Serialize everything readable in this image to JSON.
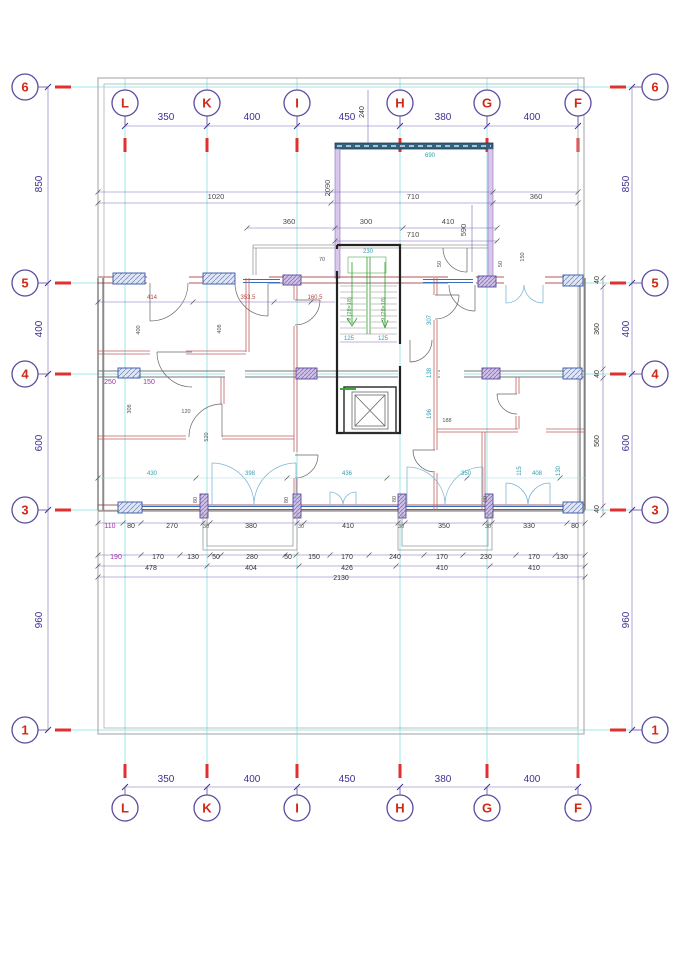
{
  "drawing": {
    "type": "architectural-floor-plan",
    "grid": {
      "columns": [
        {
          "label": "L",
          "x": 125
        },
        {
          "label": "K",
          "x": 207
        },
        {
          "label": "I",
          "x": 297
        },
        {
          "label": "H",
          "x": 400
        },
        {
          "label": "G",
          "x": 487
        },
        {
          "label": "F",
          "x": 578
        }
      ],
      "rows": [
        {
          "label": "6",
          "y": 87
        },
        {
          "label": "5",
          "y": 283
        },
        {
          "label": "4",
          "y": 374
        },
        {
          "label": "3",
          "y": 510
        },
        {
          "label": "1",
          "y": 730
        }
      ],
      "top_bubble_y": 103,
      "bottom_bubble_y": 808,
      "left_bubble_x": 25,
      "right_bubble_x": 655
    },
    "column_spacings": [
      "350",
      "400",
      "450",
      "380",
      "400"
    ],
    "row_spacings": [
      "850",
      "400",
      "600",
      "960"
    ],
    "stair_flight_label": "9 (28×18)",
    "colors": {
      "grid_line": "#9fe4e4",
      "bubble_stroke": "#5b4a9e",
      "bubble_label": "#d22818",
      "red_tick": "#e03030",
      "dim_major": "#3c3294",
      "wall_fill": "#d9c7ec",
      "window_blue": "#3a6fc0",
      "stair_green": "#2f9e2f",
      "partition_red": "#c06060"
    },
    "dimensions": [
      {
        "text": "350",
        "x": 166,
        "y": 120,
        "cls": "maj"
      },
      {
        "text": "400",
        "x": 252,
        "y": 120,
        "cls": "maj"
      },
      {
        "text": "450",
        "x": 347,
        "y": 120,
        "cls": "maj"
      },
      {
        "text": "240",
        "x": 364,
        "y": 112,
        "cls": "chain",
        "rot": 1
      },
      {
        "text": "380",
        "x": 443,
        "y": 120,
        "cls": "maj"
      },
      {
        "text": "400",
        "x": 532,
        "y": 120,
        "cls": "maj"
      },
      {
        "text": "350",
        "x": 166,
        "y": 782,
        "cls": "maj"
      },
      {
        "text": "400",
        "x": 252,
        "y": 782,
        "cls": "maj"
      },
      {
        "text": "450",
        "x": 347,
        "y": 782,
        "cls": "maj"
      },
      {
        "text": "380",
        "x": 443,
        "y": 782,
        "cls": "maj"
      },
      {
        "text": "400",
        "x": 532,
        "y": 782,
        "cls": "maj"
      },
      {
        "text": "850",
        "x": 42,
        "y": 184,
        "cls": "maj",
        "rot": 1
      },
      {
        "text": "400",
        "x": 42,
        "y": 329,
        "cls": "maj",
        "rot": 1
      },
      {
        "text": "600",
        "x": 42,
        "y": 443,
        "cls": "maj",
        "rot": 1
      },
      {
        "text": "960",
        "x": 42,
        "y": 620,
        "cls": "maj",
        "rot": 1
      },
      {
        "text": "850",
        "x": 629,
        "y": 184,
        "cls": "maj",
        "rot": 1
      },
      {
        "text": "400",
        "x": 629,
        "y": 329,
        "cls": "maj",
        "rot": 1
      },
      {
        "text": "600",
        "x": 629,
        "y": 443,
        "cls": "maj",
        "rot": 1
      },
      {
        "text": "960",
        "x": 629,
        "y": 620,
        "cls": "maj",
        "rot": 1
      },
      {
        "text": "40",
        "x": 599,
        "y": 280,
        "cls": "chain",
        "rot": 1
      },
      {
        "text": "360",
        "x": 599,
        "y": 329,
        "cls": "chain",
        "rot": 1
      },
      {
        "text": "40",
        "x": 599,
        "y": 374,
        "cls": "chain",
        "rot": 1
      },
      {
        "text": "560",
        "x": 599,
        "y": 441,
        "cls": "chain",
        "rot": 1
      },
      {
        "text": "40",
        "x": 599,
        "y": 509,
        "cls": "chain",
        "rot": 1
      },
      {
        "text": "1020",
        "x": 216,
        "y": 199,
        "cls": "mid"
      },
      {
        "text": "710",
        "x": 413,
        "y": 199,
        "cls": "mid"
      },
      {
        "text": "360",
        "x": 536,
        "y": 199,
        "cls": "mid"
      },
      {
        "text": "690",
        "x": 430,
        "y": 157,
        "cls": "cyan"
      },
      {
        "text": "2090",
        "x": 330,
        "y": 188,
        "cls": "mid",
        "rot": 1
      },
      {
        "text": "360",
        "x": 289,
        "y": 224,
        "cls": "mid"
      },
      {
        "text": "300",
        "x": 366,
        "y": 224,
        "cls": "mid"
      },
      {
        "text": "410",
        "x": 448,
        "y": 224,
        "cls": "mid"
      },
      {
        "text": "710",
        "x": 413,
        "y": 237,
        "cls": "mid"
      },
      {
        "text": "590",
        "x": 466,
        "y": 230,
        "cls": "mid",
        "rot": 1
      },
      {
        "text": "70",
        "x": 322,
        "y": 261,
        "cls": "tiny"
      },
      {
        "text": "50",
        "x": 441,
        "y": 264,
        "cls": "tiny",
        "rot": 1
      },
      {
        "text": "50",
        "x": 502,
        "y": 264,
        "cls": "tiny",
        "rot": 1
      },
      {
        "text": "150",
        "x": 524,
        "y": 257,
        "cls": "tiny",
        "rot": 1
      },
      {
        "text": "414",
        "x": 152,
        "y": 299,
        "cls": "red"
      },
      {
        "text": "353.5",
        "x": 248,
        "y": 299,
        "cls": "red"
      },
      {
        "text": "160.5",
        "x": 315,
        "y": 299,
        "cls": "red"
      },
      {
        "text": "400",
        "x": 140,
        "y": 330,
        "cls": "tiny",
        "rot": 1
      },
      {
        "text": "408",
        "x": 221,
        "y": 329,
        "cls": "tiny",
        "rot": 1
      },
      {
        "text": "250",
        "x": 110,
        "y": 384,
        "cls": "chainp"
      },
      {
        "text": "150",
        "x": 149,
        "y": 384,
        "cls": "chainp"
      },
      {
        "text": "308",
        "x": 131,
        "y": 409,
        "cls": "tiny",
        "rot": 1
      },
      {
        "text": "120",
        "x": 186,
        "y": 413,
        "cls": "tiny"
      },
      {
        "text": "520",
        "x": 208,
        "y": 437,
        "cls": "tiny",
        "rot": 1
      },
      {
        "text": "307",
        "x": 431,
        "y": 320,
        "cls": "cyan",
        "rot": 1
      },
      {
        "text": "138",
        "x": 431,
        "y": 373,
        "cls": "cyan",
        "rot": 1
      },
      {
        "text": "196",
        "x": 431,
        "y": 414,
        "cls": "cyan",
        "rot": 1
      },
      {
        "text": "188",
        "x": 447,
        "y": 422,
        "cls": "tiny"
      },
      {
        "text": "230",
        "x": 368,
        "y": 253,
        "cls": "cyan"
      },
      {
        "text": "125",
        "x": 349,
        "y": 340,
        "cls": "cyan"
      },
      {
        "text": "125",
        "x": 383,
        "y": 340,
        "cls": "cyan"
      },
      {
        "text": "430",
        "x": 152,
        "y": 475,
        "cls": "cyan"
      },
      {
        "text": "398",
        "x": 250,
        "y": 475,
        "cls": "cyan"
      },
      {
        "text": "436",
        "x": 347,
        "y": 475,
        "cls": "cyan"
      },
      {
        "text": "350",
        "x": 466,
        "y": 475,
        "cls": "cyan"
      },
      {
        "text": "408",
        "x": 537,
        "y": 475,
        "cls": "cyan"
      },
      {
        "text": "115",
        "x": 521,
        "y": 471,
        "cls": "cyan",
        "rot": 1
      },
      {
        "text": "130",
        "x": 560,
        "y": 471,
        "cls": "cyan",
        "rot": 1
      },
      {
        "text": "80",
        "x": 197,
        "y": 500,
        "cls": "tiny",
        "rot": 1
      },
      {
        "text": "80",
        "x": 288,
        "y": 500,
        "cls": "tiny",
        "rot": 1
      },
      {
        "text": "80",
        "x": 396,
        "y": 499,
        "cls": "tiny",
        "rot": 1
      },
      {
        "text": "80",
        "x": 487,
        "y": 499,
        "cls": "tiny",
        "rot": 1
      },
      {
        "text": "110",
        "x": 110,
        "y": 528,
        "cls": "chainp"
      },
      {
        "text": "80",
        "x": 131,
        "y": 528,
        "cls": "chain"
      },
      {
        "text": "270",
        "x": 172,
        "y": 528,
        "cls": "chain"
      },
      {
        "text": "30",
        "x": 206,
        "y": 528,
        "cls": "tiny"
      },
      {
        "text": "380",
        "x": 251,
        "y": 528,
        "cls": "chain"
      },
      {
        "text": "30",
        "x": 301,
        "y": 528,
        "cls": "tiny"
      },
      {
        "text": "410",
        "x": 348,
        "y": 528,
        "cls": "chain"
      },
      {
        "text": "30",
        "x": 401,
        "y": 528,
        "cls": "tiny"
      },
      {
        "text": "350",
        "x": 444,
        "y": 528,
        "cls": "chain"
      },
      {
        "text": "30",
        "x": 488,
        "y": 528,
        "cls": "tiny"
      },
      {
        "text": "330",
        "x": 529,
        "y": 528,
        "cls": "chain"
      },
      {
        "text": "80",
        "x": 575,
        "y": 528,
        "cls": "chain"
      },
      {
        "text": "190",
        "x": 116,
        "y": 559,
        "cls": "chainp"
      },
      {
        "text": "170",
        "x": 158,
        "y": 559,
        "cls": "chain"
      },
      {
        "text": "130",
        "x": 193,
        "y": 559,
        "cls": "chain"
      },
      {
        "text": "50",
        "x": 216,
        "y": 559,
        "cls": "chain"
      },
      {
        "text": "280",
        "x": 252,
        "y": 559,
        "cls": "chain"
      },
      {
        "text": "50",
        "x": 288,
        "y": 559,
        "cls": "chain"
      },
      {
        "text": "150",
        "x": 314,
        "y": 559,
        "cls": "chain"
      },
      {
        "text": "170",
        "x": 347,
        "y": 559,
        "cls": "chain"
      },
      {
        "text": "240",
        "x": 395,
        "y": 559,
        "cls": "chain"
      },
      {
        "text": "170",
        "x": 442,
        "y": 559,
        "cls": "chain"
      },
      {
        "text": "230",
        "x": 486,
        "y": 559,
        "cls": "chain"
      },
      {
        "text": "170",
        "x": 534,
        "y": 559,
        "cls": "chain"
      },
      {
        "text": "130",
        "x": 562,
        "y": 559,
        "cls": "chain"
      },
      {
        "text": "478",
        "x": 151,
        "y": 570,
        "cls": "chain"
      },
      {
        "text": "404",
        "x": 251,
        "y": 570,
        "cls": "chain"
      },
      {
        "text": "426",
        "x": 347,
        "y": 570,
        "cls": "chain"
      },
      {
        "text": "410",
        "x": 442,
        "y": 570,
        "cls": "chain"
      },
      {
        "text": "410",
        "x": 534,
        "y": 570,
        "cls": "chain"
      },
      {
        "text": "2130",
        "x": 341,
        "y": 580,
        "cls": "chain"
      }
    ],
    "stair_labels": [
      {
        "text": "9 (28×18)",
        "x": 351,
        "y": 309,
        "cls": "green",
        "rot": 1
      },
      {
        "text": "9 (28×18)",
        "x": 385,
        "y": 309,
        "cls": "green",
        "rot": 1
      }
    ]
  }
}
